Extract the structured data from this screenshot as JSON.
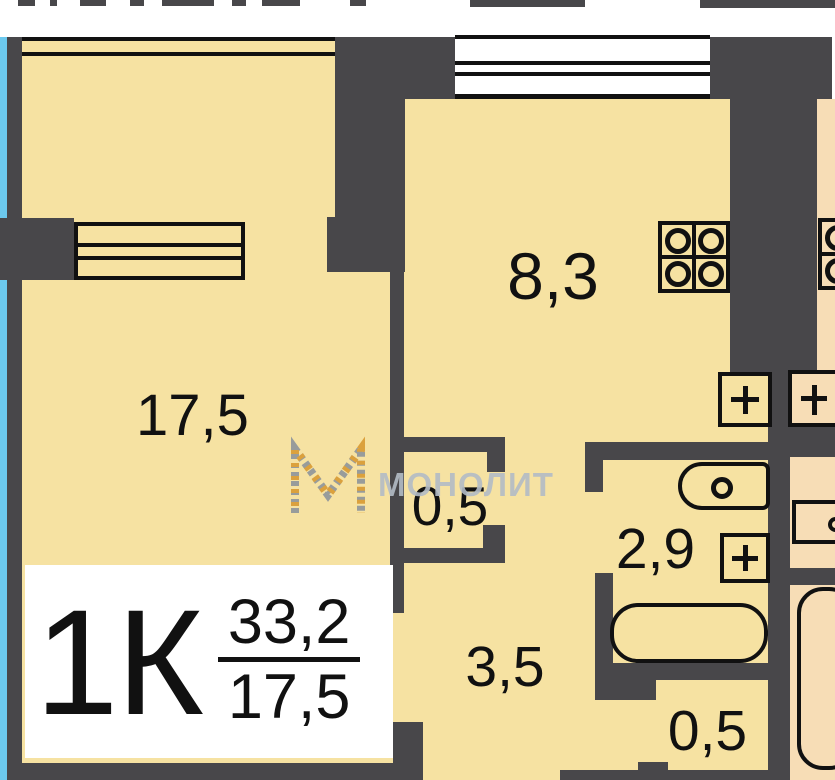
{
  "plan": {
    "type": "apartment-floor-plan",
    "rooms": {
      "living": "17,5",
      "kitchen": "8,3",
      "closet": "0,5",
      "bathroom": "2,9",
      "hallway": "3,5",
      "storage": "0,5"
    },
    "info": {
      "unit": "1К",
      "total_area": "33,2",
      "living_area": "17,5"
    },
    "watermark": {
      "text": "МОНОЛИТ"
    },
    "icons": {
      "stove": "stove-4-burners",
      "radiator": "window-radiator",
      "toilet": "toilet-bowl",
      "bathtub": "bathtub",
      "vent": "plus-in-box",
      "sink": "sink"
    },
    "colors": {
      "wall": "#48474a",
      "room_fill": "#f6e2a2",
      "neighbor_fill": "#f7ddb6",
      "exterior_blue": "#6cc9ee",
      "outline": "#111111",
      "watermark_gray": "#b3bcc6",
      "watermark_orange": "#d99a33"
    }
  }
}
